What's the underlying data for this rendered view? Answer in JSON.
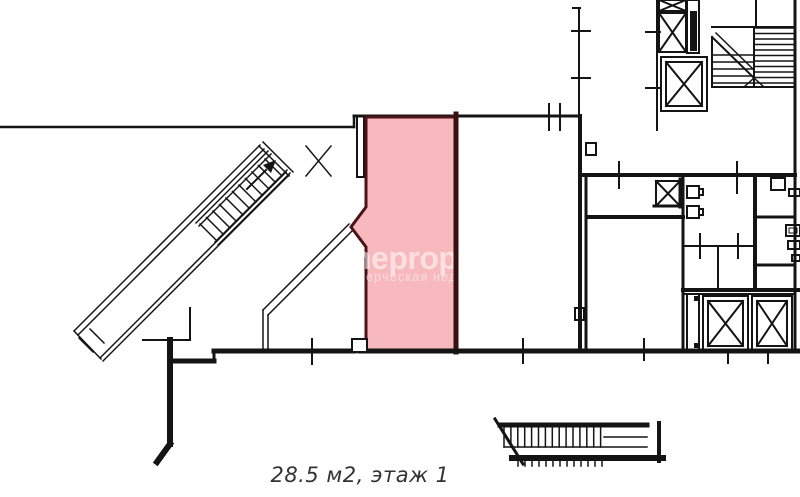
{
  "page": {
    "background": "#ffffff"
  },
  "floorplan": {
    "line_color": "#141414",
    "highlight": {
      "fill": "#f7b9bd",
      "stroke": "#4a1316",
      "wall_color": "#38100f"
    },
    "icons": {
      "elevator_shaft": "crossed-box",
      "staircase": "tread-lines",
      "door_swing": "x-marker",
      "direction_arrow": "solid-triangle-up-right"
    }
  },
  "watermark": {
    "title_fragment": "neprope",
    "subtitle_fragment": "ерческая недвиж",
    "color": "#ffffff"
  },
  "caption": {
    "text": "28.5 м2, этаж 1",
    "color": "#333333"
  }
}
